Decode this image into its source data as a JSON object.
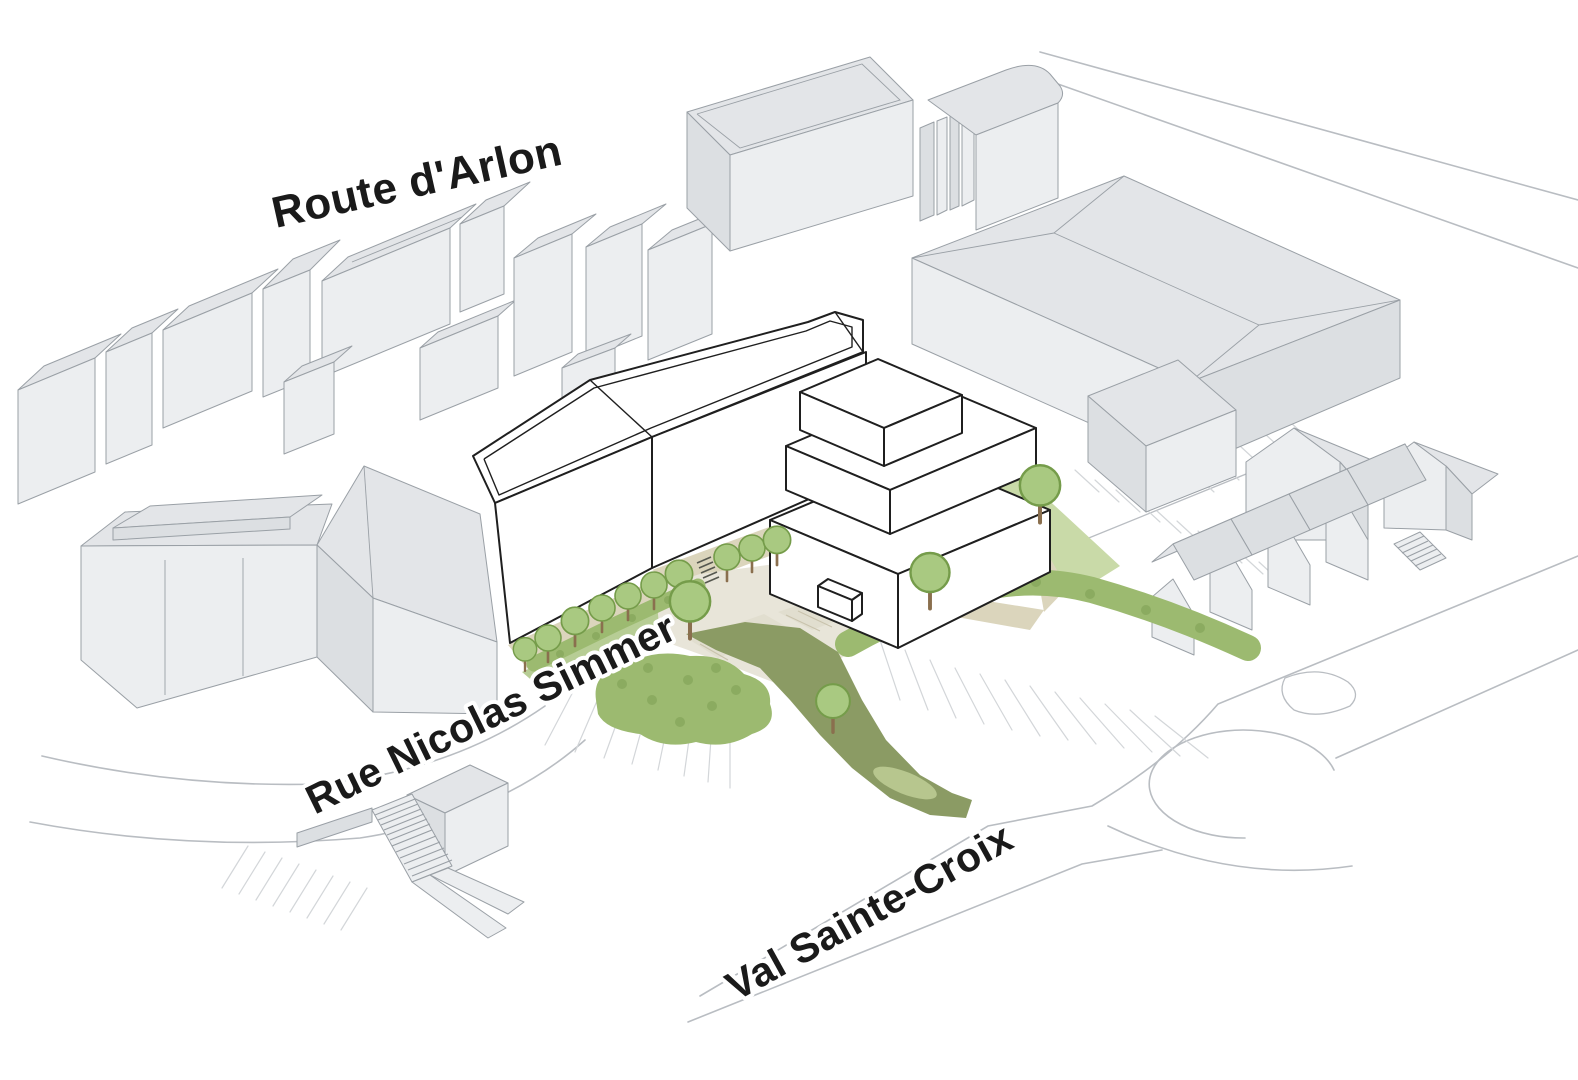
{
  "diagram": {
    "type": "axonometric-site-plan",
    "streets": {
      "route_arlon": "Route d'Arlon",
      "rue_nicolas_simmer": "Rue Nicolas Simmer",
      "val_sainte_croix": "Val Sainte-Croix"
    },
    "colors": {
      "bg": "#ffffff",
      "context_face": "#eceef0",
      "context_roof": "#e3e5e8",
      "context_side": "#dcdfe2",
      "context_stroke": "#9aa0a6",
      "project_fill": "#ffffff",
      "project_stroke": "#1f1f1f",
      "path_tan": "#dbd5bc",
      "plaza": "#e8e5d9",
      "paving": "#e1decf",
      "paving_line": "#c9c3ad",
      "lawn": "#c9daa8",
      "green_strip": "#b7cd95",
      "hedge": "#9cba70",
      "hedge_dark": "#7d9f53",
      "canopy": "#a9c981",
      "canopy_stroke": "#759c4a",
      "trunk": "#8a6f4e",
      "ramp_green": "#8b9b64",
      "pond": "#b7c68e",
      "road_stroke": "#b9bdc2",
      "hatch_stroke": "#d3d6d9",
      "label_color": "#1a1a1a"
    }
  }
}
